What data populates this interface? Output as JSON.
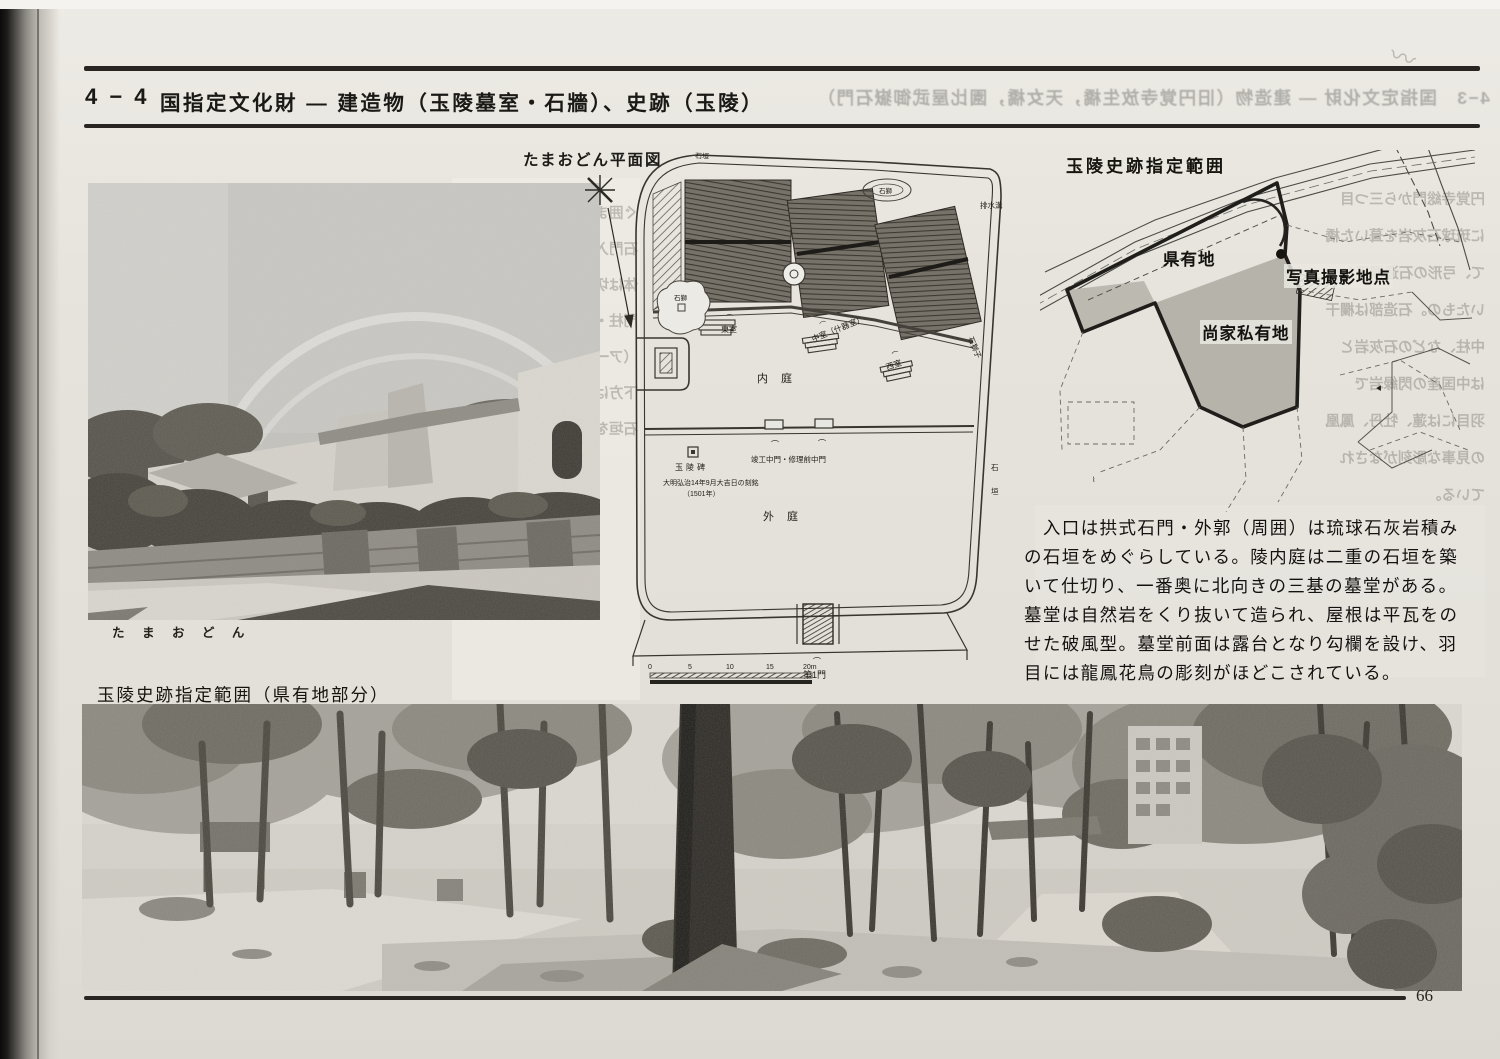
{
  "page_number": "66",
  "header": {
    "section_no": "4 − 4",
    "title": "国指定文化財 ― 建造物（玉陵墓室・石牆）、史跡（玉陵）",
    "showthrough": "4−3　国指定文化財 ― 建造物（旧円覚寺放生橋，天女橋，園比屋武御嶽石門）"
  },
  "photo_tamaudun": {
    "caption": "た ま お ど ん"
  },
  "plan": {
    "title": "たまおどん平面図",
    "labels": {
      "east_chamber": "東室",
      "middle_chamber": "中室（什器室）",
      "west_chamber": "西室",
      "stone_lion": "石獅子",
      "stone_lion_small": "石獅",
      "inner_court": "内 庭",
      "outer_court": "外 庭",
      "drain": "排水溝",
      "stone_wall_top": "石垣",
      "stone_wall_right_a": "石",
      "stone_wall_right_b": "垣",
      "gate_mark": "⌒"
    },
    "monument": {
      "name": "玉陵碑",
      "note": "大明弘治14年9月大吉日の刻銘",
      "year": "（1501年）"
    },
    "gates": {
      "middle": "竣工中門・修理前中門",
      "first": "第1門"
    },
    "scale_ticks": [
      "0",
      "5",
      "10",
      "15",
      "20m"
    ]
  },
  "map": {
    "title": "玉陵史跡指定範囲",
    "labels": {
      "prefectural_land": "県有地",
      "photo_point": "写真撮影地点",
      "sho_family_private_land": "尚家私有地"
    }
  },
  "description": {
    "lines": [
      "　入口は拱式石門・外郭（周囲）は琉球石灰岩積み",
      "の石垣をめぐらしている。陵内庭は二重の石垣を築",
      "いて仕切り、一番奥に北向きの三基の墓堂がある。",
      "墓堂は自然岩をくり抜いて造られ、屋根は平瓦をの",
      "せた破風型。墓堂前面は露台となり勾欄を設け、羽",
      "目には龍鳳花鳥の彫刻がほどこされている。"
    ]
  },
  "photo_park": {
    "caption": "玉陵史跡指定範囲（県有地部分）"
  },
  "showthrough_left": {
    "lines": [
      "ぐ囲まれた石造で",
      "石門入りの固門",
      "体は切石積で造ら",
      "門柱・笠石は琉球",
      "（アーチ）門に",
      "下方はバラス敷",
      "石垣を取り囲む"
    ]
  },
  "showthrough_right": {
    "lines": [
      "円覚寺総門から三つ目",
      "に琉球石灰岩を葺いた橋",
      "て、弓形の石造欄干と",
      "いたもの。石造部は欄干",
      "中柱、などの石灰岩と",
      "は中国産の閃緑岩で",
      "羽目には蓮、牡丹、鳳凰",
      "の見事な彫刻がなされ",
      "ている。"
    ]
  }
}
